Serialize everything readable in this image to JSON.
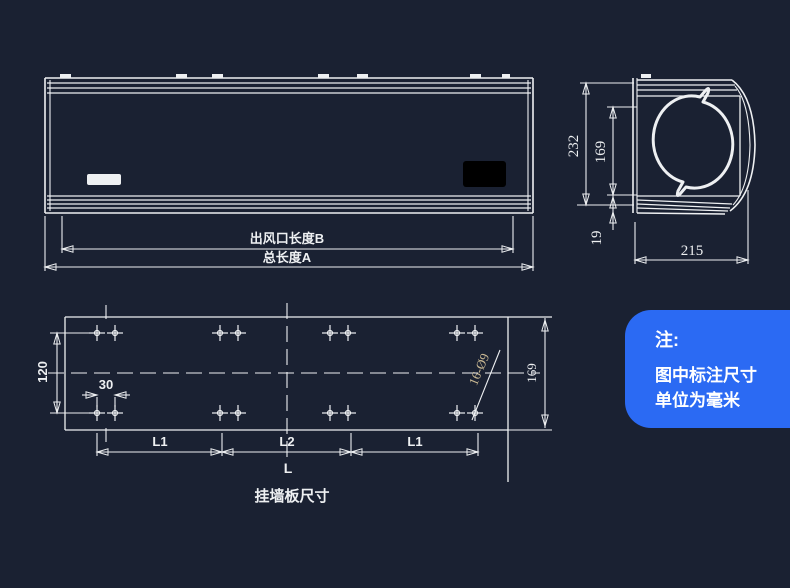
{
  "colors": {
    "background": "#1a2132",
    "line": "#eef0f2",
    "note_background": "#2b6af3",
    "note_text": "#ffffff",
    "holes_label_color": "#c9b893"
  },
  "front_view": {
    "outlet_dim_label": "出风口长度B",
    "total_dim_label": "总长度A"
  },
  "side_view": {
    "height_dim": "232",
    "face_height_dim": "169",
    "bottom_dim": "19",
    "depth_dim": "215"
  },
  "plate": {
    "title": "挂墙板尺寸",
    "row_spacing_dim": "120",
    "hole_pair_dim": "30",
    "height_dim": "169",
    "holes_label": "16-Ø9",
    "l1_left": "L1",
    "l2": "L2",
    "l1_right": "L1",
    "l_total": "L"
  },
  "note": {
    "heading": "注:",
    "line1": "图中标注尺寸",
    "line2": "单位为毫米"
  }
}
